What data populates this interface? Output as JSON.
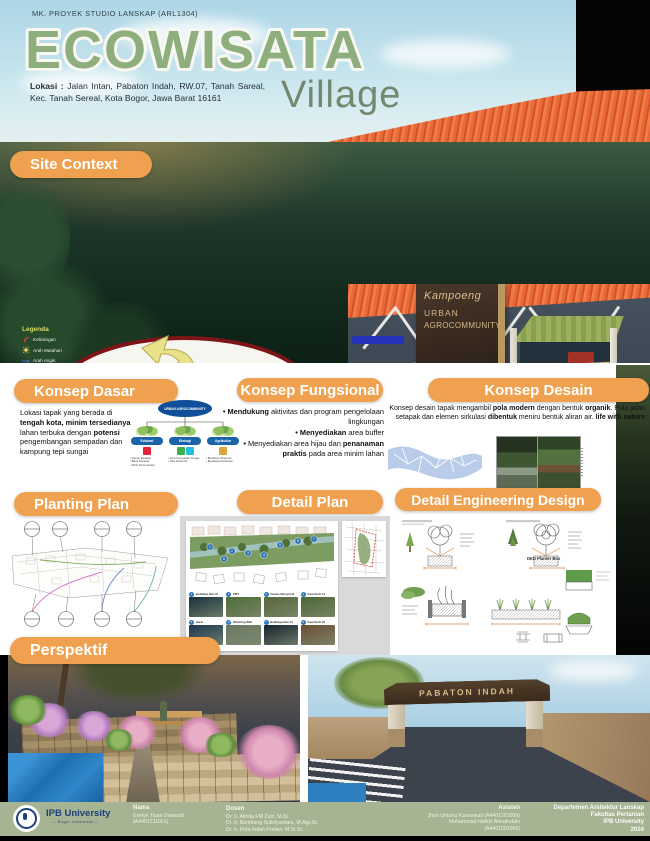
{
  "colors": {
    "accent": "#EFA14F",
    "title_green": "#8FAE7D",
    "footer_sage": "#A6B493",
    "map_rim": "#7D1518",
    "node_blue": "#1B63A8",
    "number_blue": "#2E74B5"
  },
  "header": {
    "course": "MK. PROYEK STUDIO LANSKAP (ARL1304)",
    "title": "ECOWISATA",
    "subtitle": "Village",
    "location_label": "Lokasi :",
    "location_text": "Jalan Intan, Pabaton Indah, RW.07, Tanah Sareal, Kec. Tanah Sereal, Kota Bogor, Jawa Barat 16161"
  },
  "site_context": {
    "heading": "Site Context",
    "legend": {
      "title": "Legenda",
      "items": [
        {
          "icon": "noise",
          "label": "Kebisingan"
        },
        {
          "icon": "sun",
          "label": "Arah Matahari"
        },
        {
          "icon": "wind",
          "label": "Arah Angin"
        },
        {
          "icon": "circulation",
          "label": "Sirkulasi"
        }
      ]
    },
    "stats_col1": [
      {
        "label": "Luas Tapak",
        "value": ": 4 Hektar"
      },
      {
        "label": "Suhu Udara",
        "value": ": 23 - 28 °C"
      },
      {
        "label": "Curah Hujan",
        "value": ": 3.500 - 4000 mm/tahun"
      }
    ],
    "stats_col2": [
      {
        "label": "Topografi",
        "value": ": Cukup Landai"
      },
      {
        "label": "Ketinggian",
        "value": ": 0 - 184 mdpl"
      },
      {
        "label": "Kelembaban",
        "value": ": 80% - 95%"
      }
    ],
    "stats_col3": [
      {
        "label": "Kec. Angin",
        "value": ": 15 - 30 km/jam"
      },
      {
        "label": "Hidrologi",
        "value": ": Terdapat sumber air (sungai dan mata air)"
      },
      {
        "label": "Jenis Tanah",
        "value": ": Latosol, Regosol, Andosol, dan Organosol"
      }
    ],
    "sign": {
      "line1": "Kampoeng",
      "line2": "URBAN",
      "line3": "AGROCOMMUNITY",
      "line4": "Kampoeng Bersih"
    }
  },
  "konsep_dasar": {
    "heading": "Konsep Dasar",
    "paragraph": [
      {
        "t": "Lokasi tapak yang berada di "
      },
      {
        "t": "tengah kota, minim tersedianya",
        "b": true
      },
      {
        "t": " lahan terbuka dengan "
      },
      {
        "t": "potensi",
        "b": true
      },
      {
        "t": " pengembangan sempadan dan kampung tepi sungai"
      }
    ],
    "diagram": {
      "root": "URBAN AGROCOMMUNITY",
      "nodes": [
        {
          "label": "Edukasi",
          "sdg_colors": [
            "#E5243B"
          ],
          "bullets": [
            "Taman Edukasi",
            "Bank Sampah",
            "MCK Percontohan"
          ]
        },
        {
          "label": "Ekologi",
          "sdg_colors": [
            "#3EB049",
            "#26BDE2"
          ],
          "bullets": [
            "Area Sempadan Sungai",
            "Tata Kelola Air"
          ]
        },
        {
          "label": "Agrikultur",
          "sdg_colors": [
            "#DDA63A"
          ],
          "bullets": [
            "Budidaya Tanaman",
            "Budidaya Perikanan"
          ]
        }
      ]
    }
  },
  "konsep_fungsional": {
    "heading": "Konsep Fungsional",
    "bullets": [
      [
        {
          "t": "Mendukung",
          "b": true
        },
        {
          "t": " aktivitas dan program pengelolaan lingkungan"
        }
      ],
      [
        {
          "t": "Menyediakan",
          "b": true
        },
        {
          "t": " area buffer"
        }
      ],
      [
        {
          "t": "Menyediakan area hijau dan "
        },
        {
          "t": "penanaman praktis",
          "b": true
        },
        {
          "t": " pada area minim lahan"
        }
      ]
    ]
  },
  "konsep_desain": {
    "heading": "Konsep Desain",
    "paragraph": [
      {
        "t": "Konsep desain tapak mengambil "
      },
      {
        "t": "pola modern",
        "b": true
      },
      {
        "t": " dengan bentuk "
      },
      {
        "t": "organik",
        "b": true
      },
      {
        "t": ". Pola jalan setapak dan elemen sirkulasi "
      },
      {
        "t": "dibentuk",
        "b": true
      },
      {
        "t": " meniru bentuk aliran air. "
      },
      {
        "t": "life with nature",
        "b": true
      }
    ]
  },
  "planting": {
    "heading": "Planting Plan"
  },
  "detail_plan": {
    "heading": "Detail Plan",
    "items": [
      {
        "num": "1",
        "label": "Budidaya Ikan #1",
        "tone": "#16303c"
      },
      {
        "num": "2",
        "label": "KWT",
        "tone": "#4e6b35"
      },
      {
        "num": "3",
        "label": "Taman Hidroponik",
        "tone": "#57663a"
      },
      {
        "num": "4",
        "label": "View Deck #1",
        "tone": "#4c6633"
      },
      {
        "num": "5",
        "label": "Mural",
        "tone": "#1d3550"
      },
      {
        "num": "6",
        "label": "Retaining Wall",
        "tone": "#6a7a62"
      },
      {
        "num": "7",
        "label": "Budidaya Ikan #2",
        "tone": "#15222e"
      },
      {
        "num": "8",
        "label": "View Deck #2",
        "tone": "#6b4f33"
      }
    ]
  },
  "ded": {
    "heading": "Detail Engineering Design",
    "caption": "DED Planter Box"
  },
  "perspektif": {
    "heading": "Perspektif",
    "gate_text": "PABATON INDAH"
  },
  "footer": {
    "brand": "IPB University",
    "brand_sub": "— Bogor Indonesia —",
    "nama_label": "Nama",
    "nama_lines": [
      "Evelyn Tissa Oswandi",
      "(A4401211001)"
    ],
    "dosen_label": "Dosen",
    "dosen_lines": [
      "Dr. Ir. Alinda FM Zain, M.Si",
      "Dr. Ir. Bambang Sulistyantara, M.Agr.Sc",
      "Dr. Ir. Prita Indah Pratiwi, M.Si.Sc"
    ],
    "asisten_label": "Asisten",
    "asisten_lines": [
      "Jhon Untung Karosekali (A4401201059)",
      "Muhammad Hafidz Ahnafuddin",
      "(A4401201065)"
    ],
    "dept_lines": [
      "Departemen Arsitektur Lanskap",
      "Fakultas Pertanian",
      "IPB University",
      "2024"
    ]
  }
}
